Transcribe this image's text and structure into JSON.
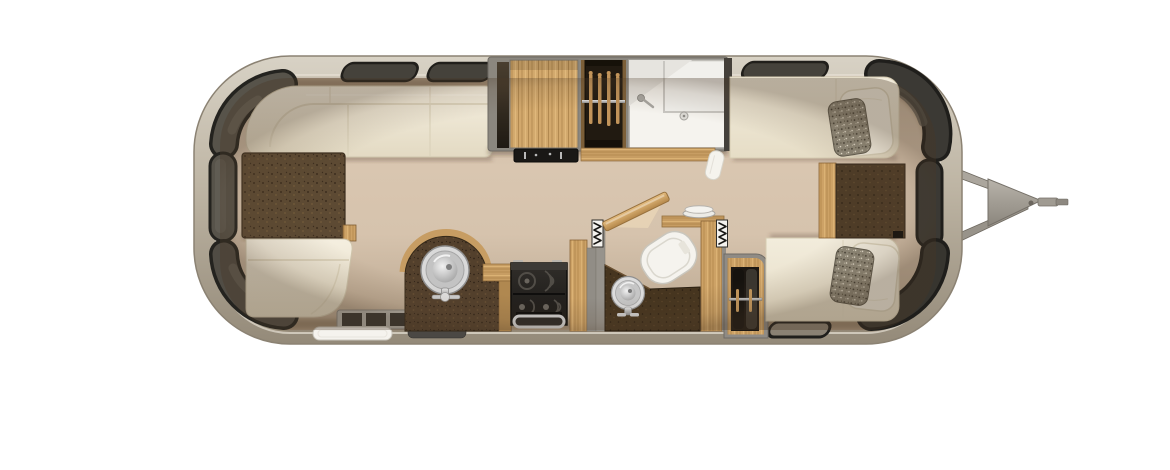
{
  "image": {
    "label": "overhead 3D floor plan of a travel trailer (airstream style) with front lounge dinette, galley kitchen, wet bath, hanging closet and rear twin-bed bedroom, hitch tongue on the right",
    "background": "#ffffff"
  },
  "palette": {
    "background": "#ffffff",
    "shell_light": "#d8d2c5",
    "shell_mid": "#beb5a4",
    "shell_dark": "#948a79",
    "floor_light": "#dbc8b2",
    "floor_dark": "#b8a58e",
    "window_frame": "#24231f",
    "window_glass_rear": "#57534a",
    "window_glass_front": "#3b3934",
    "window_glass_top": "#45423b",
    "window_glass_bottom": "#8a8173",
    "upholstery_cream": "#f2ecdc",
    "upholstery_shadow": "#d9d0b8",
    "table_brown": "#5d4a33",
    "counter_brown": "#53402c",
    "vanity_brown": "#46351f",
    "nightstand_brown": "#4e3c27",
    "wood_light": "#d2a86c",
    "wood_mid": "#c79d63",
    "wood_dark": "#8a6537",
    "appliance_black": "#1a1816",
    "stove_black": "#23201d",
    "steel": "#c6c6c6",
    "fixture_white": "#f5f3ee",
    "closet_dark": "#161109",
    "wardrobe_interior": "#1c1712",
    "pillow_speckle_base": "#8e8878",
    "mat_dark": "#4b4844",
    "hitch_metal": "#a8a39a",
    "zigzag_white": "#f4f2ee",
    "zigzag_black": "#191815"
  },
  "fixtures": {
    "front_lounge": [
      "wraparound-sofa",
      "dinette-table",
      "bench-seat"
    ],
    "entry": [
      "screen-door",
      "entry-step-pad",
      "wheel-well-mat"
    ],
    "kitchen": [
      "round-stainless-sink",
      "faucet",
      "cooktop-oven",
      "oven-handle",
      "wood-countertop"
    ],
    "mid_cabinets": [
      "pantry-cabinet",
      "hanging-closet-with-hangers",
      "wet-bath-shower"
    ],
    "bathroom": [
      "accordion-door-seals",
      "open-wood-door",
      "vanity-round-sink",
      "toilet",
      "shelf-with-plates",
      "hanging-wardrobe"
    ],
    "bedroom": [
      "twin-bed-top",
      "twin-bed-bottom",
      "white-pillows",
      "speckled-pillows",
      "nightstand"
    ],
    "exterior": [
      "panoramic-end-windows",
      "side-windows",
      "a-frame-hitch",
      "coupler"
    ]
  }
}
